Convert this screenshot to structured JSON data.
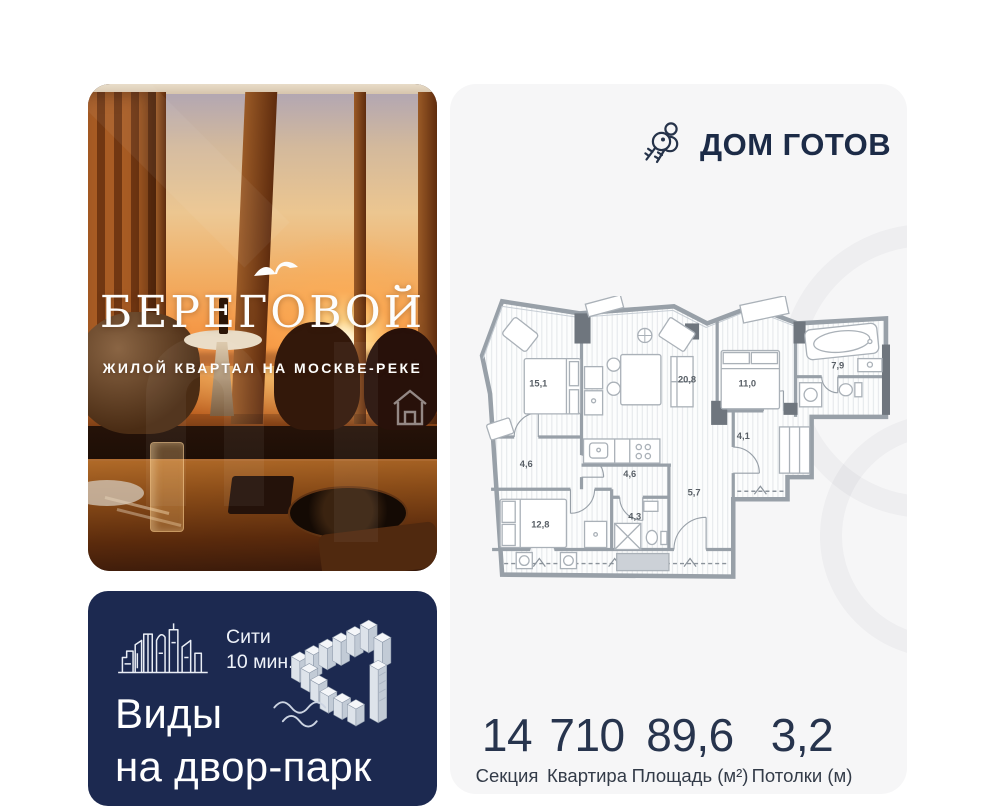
{
  "brand": {
    "title": "БЕРЕГОВОЙ",
    "subtitle": "ЖИЛОЙ КВАРТАЛ НА МОСКВЕ-РЕКЕ"
  },
  "status": {
    "label": "ДОМ ГОТОВ"
  },
  "promo": {
    "city_line1": "Сити",
    "city_line2": "10 мин.",
    "headline_line1": "Виды",
    "headline_line2": "на двор-парк"
  },
  "floor_plan": {
    "rooms": [
      {
        "area": "15,1"
      },
      {
        "area": "20,8"
      },
      {
        "area": "11,0"
      },
      {
        "area": "7,9"
      },
      {
        "area": "4,1"
      },
      {
        "area": "4,6"
      },
      {
        "area": "4,6"
      },
      {
        "area": "4,3"
      },
      {
        "area": "5,7"
      },
      {
        "area": "12,8"
      }
    ]
  },
  "stats": {
    "items": [
      {
        "value": "14",
        "label": "Секция"
      },
      {
        "value": "710",
        "label": "Квартира"
      },
      {
        "value": "89,6",
        "label": "Площадь (м²)"
      },
      {
        "value": "3,2",
        "label": "Потолки (м)"
      }
    ]
  },
  "colors": {
    "navy": "#1c2950",
    "card_bg": "#f6f6f7",
    "text_navy": "#1c2b47"
  }
}
